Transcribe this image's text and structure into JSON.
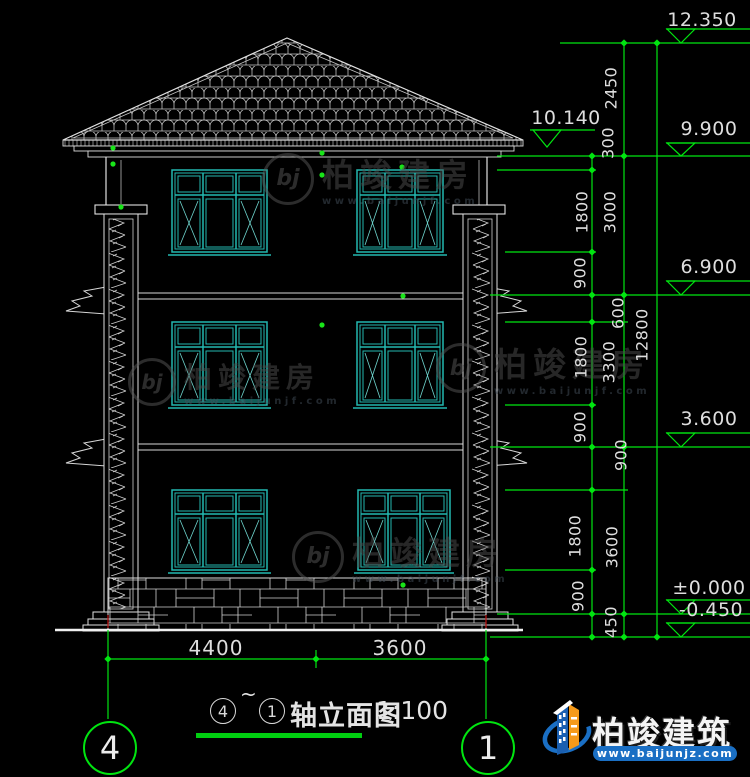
{
  "drawing": {
    "title": {
      "axis_start": "4",
      "tilde": "~",
      "axis_end": "1",
      "name": "轴立面图",
      "scale": "1:100"
    },
    "axes": {
      "left": "4",
      "right": "1"
    }
  },
  "elevations": {
    "ridge": "12.350",
    "canopy": "10.140",
    "eave": "9.900",
    "floor_3": "6.900",
    "floor_2": "3.600",
    "floor_1": "±0.000",
    "ground": "-0.450"
  },
  "dims": {
    "chain_inner": [
      "300",
      "1800",
      "900",
      "600",
      "1800",
      "900",
      "900",
      "1800",
      "900"
    ],
    "chain_middle": [
      "2450",
      "3000",
      "3300",
      "3600",
      "450"
    ],
    "chain_outer": [
      "12800"
    ],
    "bottom": [
      "4400",
      "3600"
    ]
  },
  "watermark": {
    "monogram": "bj",
    "brand": "柏竣建房",
    "url": "www.baijunjf.com"
  },
  "brand": {
    "name": "柏竣建筑",
    "url": "www.baijunjz.com"
  },
  "colors": {
    "background": "#000000",
    "line_white": "#e8e8e8",
    "window_teal": "#23b8b0",
    "dimension_green": "#00e510",
    "brand_blue": "#1a6fc4",
    "brand_orange": "#f59a1a"
  }
}
